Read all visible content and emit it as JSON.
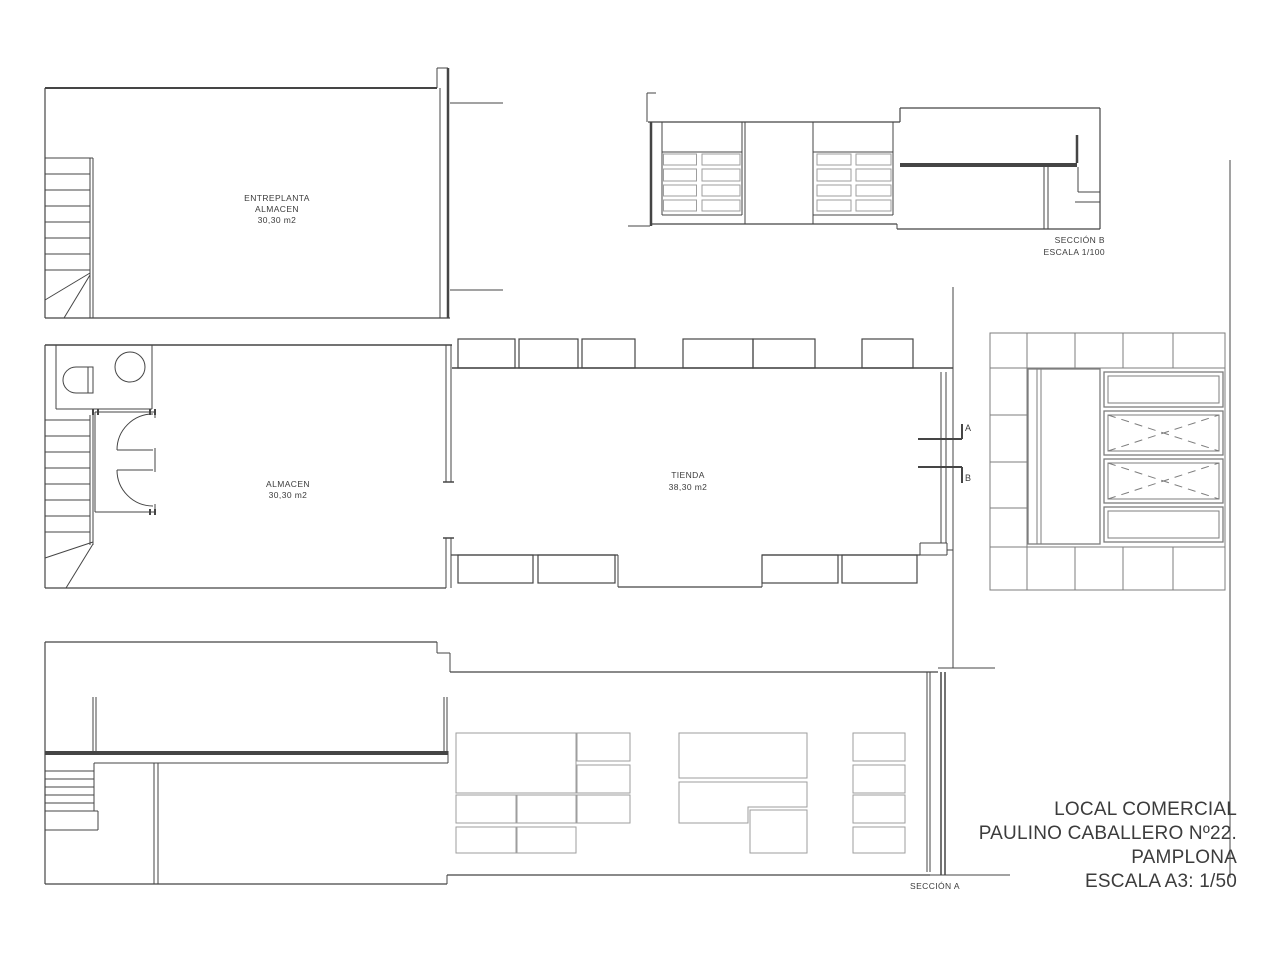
{
  "rooms": {
    "entreplanta": {
      "line1": "ENTREPLANTA",
      "line2": "ALMACEN",
      "area": "30,30 m2"
    },
    "almacen": {
      "name": "ALMACEN",
      "area": "30,30 m2"
    },
    "tienda": {
      "name": "TIENDA",
      "area": "38,30 m2"
    }
  },
  "sections": {
    "b": {
      "title": "SECCIÓN B",
      "scale": "ESCALA 1/100"
    },
    "a": {
      "title": "SECCIÓN A"
    }
  },
  "section_markers": {
    "a": "A",
    "b": "B"
  },
  "title_block": {
    "project": "LOCAL COMERCIAL",
    "address": "PAULINO CABALLERO Nº22.",
    "city": "PAMPLONA",
    "scale": "ESCALA A3: 1/50"
  },
  "colors": {
    "line_dark": "#454545",
    "line_mid": "#7d7d7d",
    "line_light": "#9e9e9e",
    "background": "#ffffff"
  }
}
